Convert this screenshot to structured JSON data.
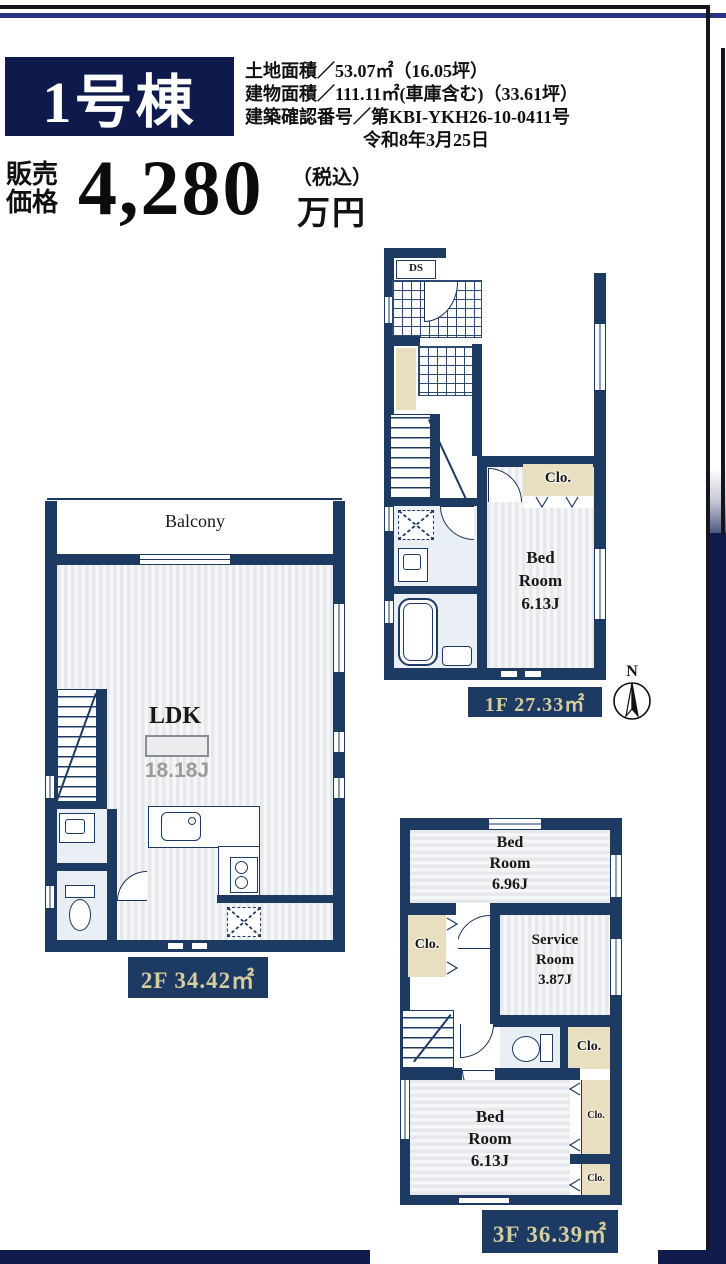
{
  "header": {
    "badge": "1号棟",
    "details": [
      "土地面積／53.07㎡（16.05坪）",
      "建物面積／111.11㎡(車庫含む)（33.61坪）",
      "建築確認番号／第KBI-YKH26-10-0411号",
      "令和8年3月25日"
    ]
  },
  "price": {
    "label_line1": "販売",
    "label_line2": "価格",
    "amount": "4,280",
    "tax_note": "（税込）",
    "unit": "万円"
  },
  "plans": {
    "f1": {
      "ds": "DS",
      "closet": "Clo.",
      "bedroom": [
        "Bed",
        "Room",
        "6.13J"
      ],
      "floor_label": "1F 27.33㎡"
    },
    "f2": {
      "balcony": "Balcony",
      "ldk": "LDK",
      "ldk_size": "18.18J",
      "floor_label": "2F 34.42㎡"
    },
    "f3": {
      "bedroom_large": [
        "Bed",
        "Room",
        "6.96J"
      ],
      "closet_left": "Clo.",
      "service_room": [
        "Service",
        "Room",
        "3.87J"
      ],
      "closet_hall": "Clo.",
      "bedroom_small": [
        "Bed",
        "Room",
        "6.13J"
      ],
      "closet_right_top": "Clo.",
      "closet_right_bottom": "Clo.",
      "floor_label": "3F 36.39㎡"
    },
    "compass": {
      "north": "N"
    }
  },
  "colors": {
    "wall_navy": "#1d3a63",
    "badge_navy": "#0e1a4b",
    "frame_navy": "#101c4e",
    "top_line_blue": "#27337f",
    "label_text_cream": "#d5cd9e",
    "closet_tan": "#e8dfc0",
    "floor_gray": "#e7e9ec",
    "bath_blue": "#e9eff5"
  }
}
